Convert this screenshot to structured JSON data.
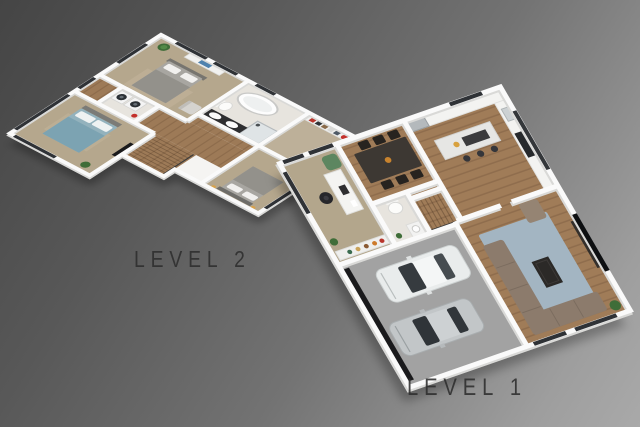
{
  "labels": {
    "level2": "LEVEL 2",
    "level1": "LEVEL 1"
  },
  "scene": {
    "type": "isometric-3d-floor-plan",
    "background_gradient": [
      "#454545",
      "#a9a9a9"
    ],
    "label_color": "#2e2e2e"
  },
  "levels": [
    {
      "id": "level-2",
      "label": "LEVEL 2",
      "rooms": [
        "master-bedroom",
        "ensuite-bathroom",
        "walk-in-closet",
        "bedroom-2",
        "laundry",
        "hallway",
        "stairs",
        "bedroom-3"
      ],
      "furniture": [
        "double-bed-gray",
        "dresser",
        "potted-plant",
        "armchair",
        "freestanding-bathtub",
        "toilet",
        "shower",
        "double-vanity",
        "closet-shelves",
        "stacked-washer-dryer",
        "double-bed-blue",
        "tv",
        "rug"
      ]
    },
    {
      "id": "level-1",
      "label": "LEVEL 1",
      "rooms": [
        "kitchen",
        "dining-area",
        "living-room",
        "garage",
        "entry-hall",
        "stairs",
        "powder-room",
        "home-office"
      ],
      "furniture": [
        "kitchen-counter",
        "kitchen-island",
        "bar-stools",
        "fridge",
        "cooktop",
        "dining-table",
        "dining-chairs",
        "sectional-sofa",
        "armchair",
        "coffee-table",
        "blue-rug",
        "wall-tv",
        "white-car",
        "silver-car",
        "garage-door",
        "desk",
        "office-chair",
        "green-armchair",
        "bookshelf",
        "toilet",
        "vanity"
      ]
    }
  ],
  "palette": {
    "wall": "#fafafa",
    "slab_side": "#d6d6d6",
    "carpet": "#b5a78d",
    "wood_floor": "#a07c58",
    "tile": "#e7e4de",
    "concrete": "#a2a2a2",
    "bed_blue": "#7ca3b2",
    "bed_gray": "#a8a6a1",
    "rug_blue": "#a3b5c2",
    "sofa_taupe": "#8c7b6c",
    "accent_red": "#c3302a",
    "accent_amber": "#d9a24a",
    "window_frame": "#2f3236",
    "shadow": "rgba(0,0,0,0.25)"
  }
}
